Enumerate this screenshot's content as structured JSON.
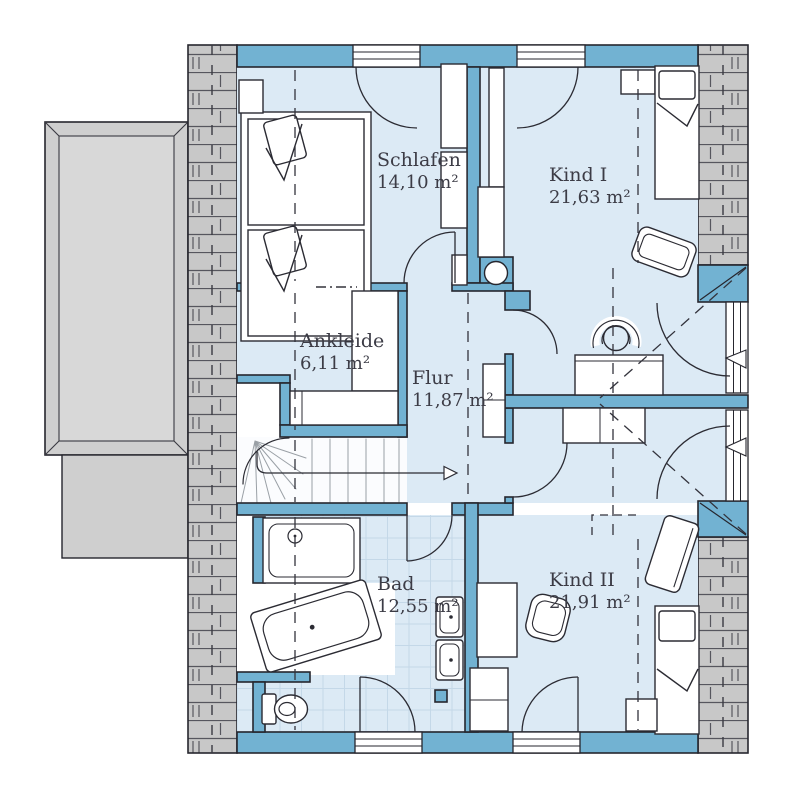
{
  "plan": {
    "type": "floor-plan",
    "rooms": [
      {
        "name": "Schlafen",
        "area": "14,10 m²"
      },
      {
        "name": "Kind I",
        "area": "21,63 m²"
      },
      {
        "name": "Ankleide",
        "area": "6,11 m²"
      },
      {
        "name": "Flur",
        "area": "11,87 m²"
      },
      {
        "name": "Bad",
        "area": "12,55 m²"
      },
      {
        "name": "Kind II",
        "area": "21,91 m²"
      }
    ],
    "colors": {
      "wall": "#72b2d2",
      "floor": "#dceaf5",
      "hatch_fill": "#c8c8c8",
      "hatch_line": "#56565e",
      "outline": "#26262e",
      "balcony": "#cfcfcf",
      "balcony_inner": "#d8d8d8",
      "tile_line": "#c4d8e8",
      "text": "#3c3c46"
    }
  }
}
